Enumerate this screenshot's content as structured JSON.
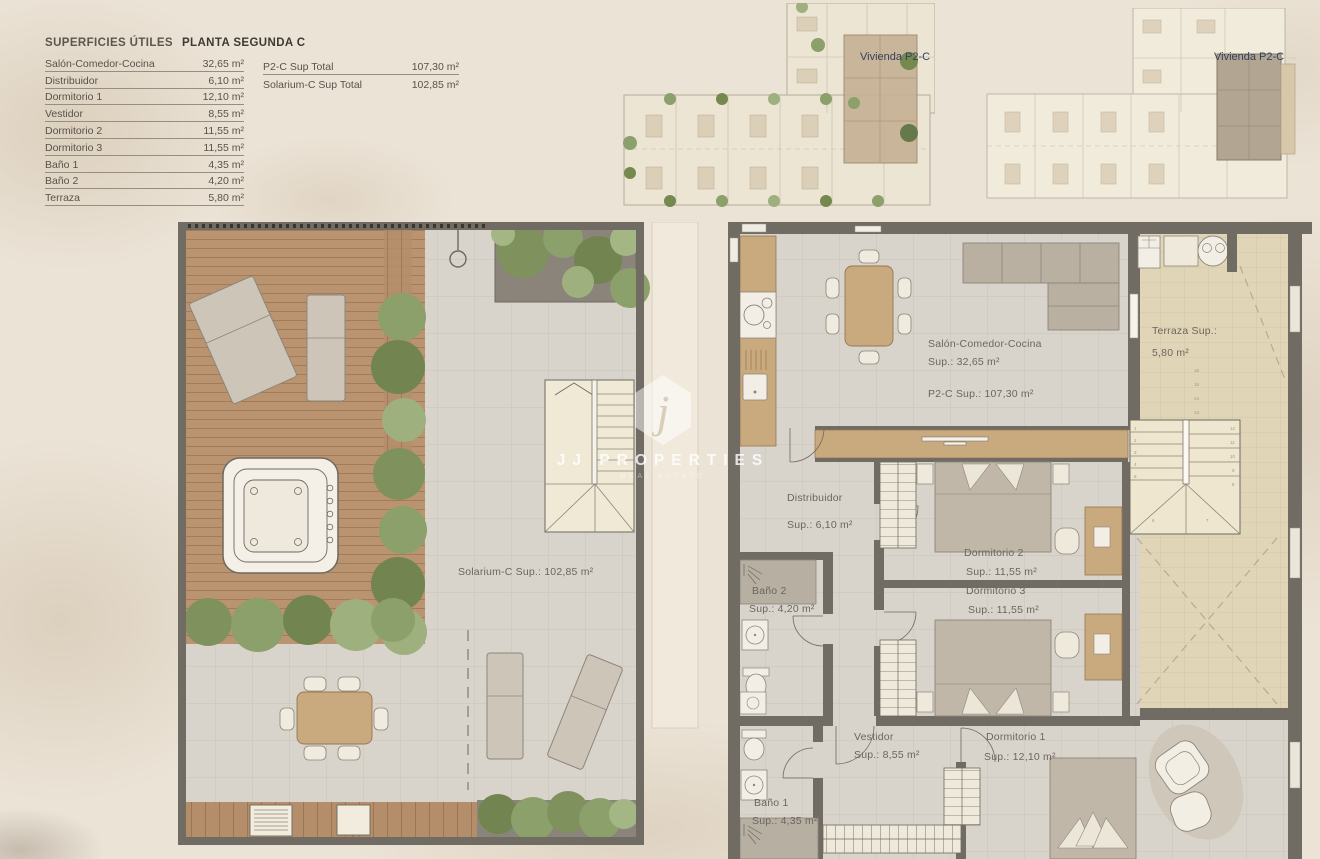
{
  "header": {
    "title": "SUPERFICIES ÚTILES",
    "subtitle": "PLANTA SEGUNDA C"
  },
  "surfaces": {
    "rows": [
      {
        "label": "Salón-Comedor-Cocina",
        "value": "32,65 m²"
      },
      {
        "label": "Distribuidor",
        "value": "6,10 m²"
      },
      {
        "label": "Dormitorio 1",
        "value": "12,10 m²"
      },
      {
        "label": "Vestidor",
        "value": "8,55 m²"
      },
      {
        "label": "Dormitorio 2",
        "value": "11,55 m²"
      },
      {
        "label": "Dormitorio 3",
        "value": "11,55 m²"
      },
      {
        "label": "Baño 1",
        "value": "4,35 m²"
      },
      {
        "label": "Baño 2",
        "value": "4,20 m²"
      },
      {
        "label": "Terraza",
        "value": "5,80 m²"
      }
    ]
  },
  "totals": {
    "rows": [
      {
        "label": "P2-C Sup Total",
        "value": "107,30 m²"
      },
      {
        "label": "Solarium-C Sup Total",
        "value": "102,85 m²"
      }
    ]
  },
  "overview": {
    "plan1_label": "Vivienda P2-C",
    "plan2_label": "Vivienda P2-C"
  },
  "solarium": {
    "area_label": "Solarium-C Sup.: 102,85 m²"
  },
  "apartment": {
    "living": {
      "name": "Salón-Comedor-Cocina",
      "sup": "Sup.: 32,65 m²",
      "total": "P2-C Sup.: 107,30 m²"
    },
    "terraza": {
      "name": "Terraza Sup.:",
      "sup": "5,80 m²"
    },
    "distribuidor": {
      "name": "Distribuidor",
      "sup": "Sup.: 6,10 m²"
    },
    "dorm2": {
      "name": "Dormitorio 2",
      "sup": "Sup.: 11,55 m²"
    },
    "dorm3": {
      "name": "Dormitorio 3",
      "sup": "Sup.: 11,55 m²"
    },
    "bano2": {
      "name": "Baño 2",
      "sup": "Sup.: 4,20 m²"
    },
    "vestidor": {
      "name": "Vestidor",
      "sup": "Sup.: 8,55 m²"
    },
    "dorm1": {
      "name": "Dormitorio 1",
      "sup": "Sup.: 12,10 m²"
    },
    "bano1": {
      "name": "Baño 1",
      "sup": "Sup.: 4,35 m²"
    },
    "stairs": {
      "steps": [
        "1",
        "2",
        "3",
        "4",
        "5",
        "6",
        "7",
        "8",
        "9",
        "10",
        "11",
        "12",
        "13",
        "14",
        "15",
        "16"
      ]
    }
  },
  "watermark": {
    "monogram": "j",
    "line1": "JJ PROPERTIES",
    "line2": "REAL ESTATE"
  },
  "colors": {
    "accent_navy": "#32405e",
    "wall": "#716c63",
    "deck_wood": "#ba9470",
    "tile": "#d8d4cc",
    "terrace_tile": "#e1d5b8",
    "greenery": "#728551"
  }
}
